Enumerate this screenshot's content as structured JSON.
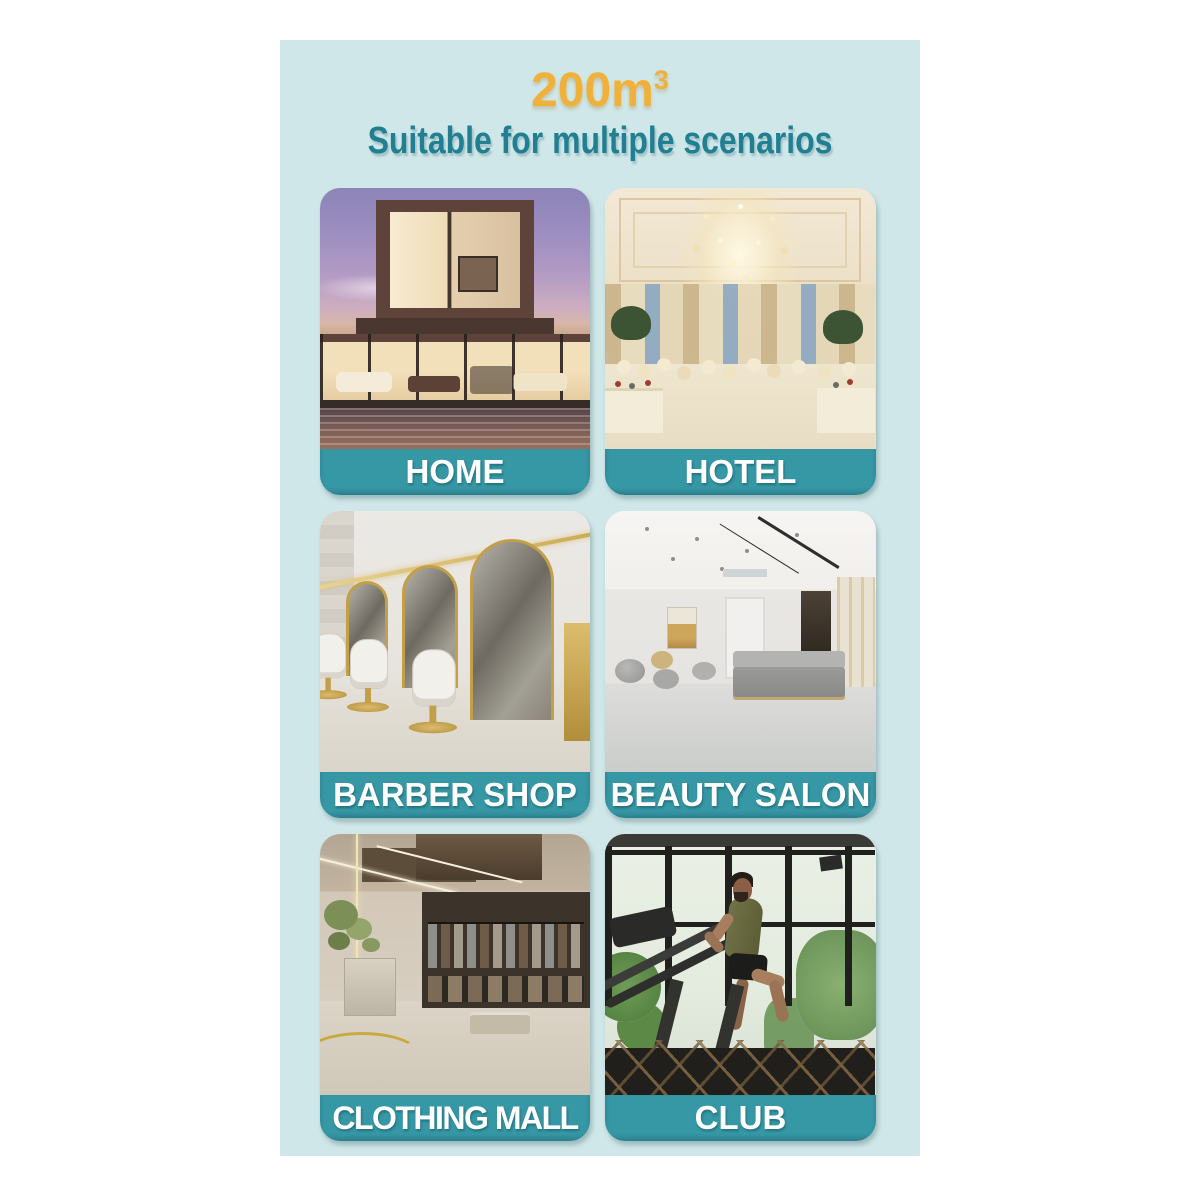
{
  "page": {
    "outer_background": "#ffffff",
    "panel_background": "#cfe7e8"
  },
  "header": {
    "volume_value": "200m",
    "volume_exponent": "3",
    "volume_color": "#f0b13a",
    "subtitle": "Suitable for multiple scenarios",
    "subtitle_color": "#217f92"
  },
  "style": {
    "label_band_color": "#3697a5",
    "label_text_color": "#ffffff"
  },
  "cards": [
    {
      "label": "HOME",
      "photo": "modern-house-at-dusk"
    },
    {
      "label": "HOTEL",
      "photo": "banquet-hall-with-chandelier"
    },
    {
      "label": "BARBER SHOP",
      "photo": "salon-with-gold-arched-mirrors"
    },
    {
      "label": "BEAUTY SALON",
      "photo": "modern-salon-lounge"
    },
    {
      "label": "CLOTHING MALL",
      "photo": "menswear-store-interior"
    },
    {
      "label": "CLUB",
      "photo": "gym-treadmill-runner"
    }
  ]
}
